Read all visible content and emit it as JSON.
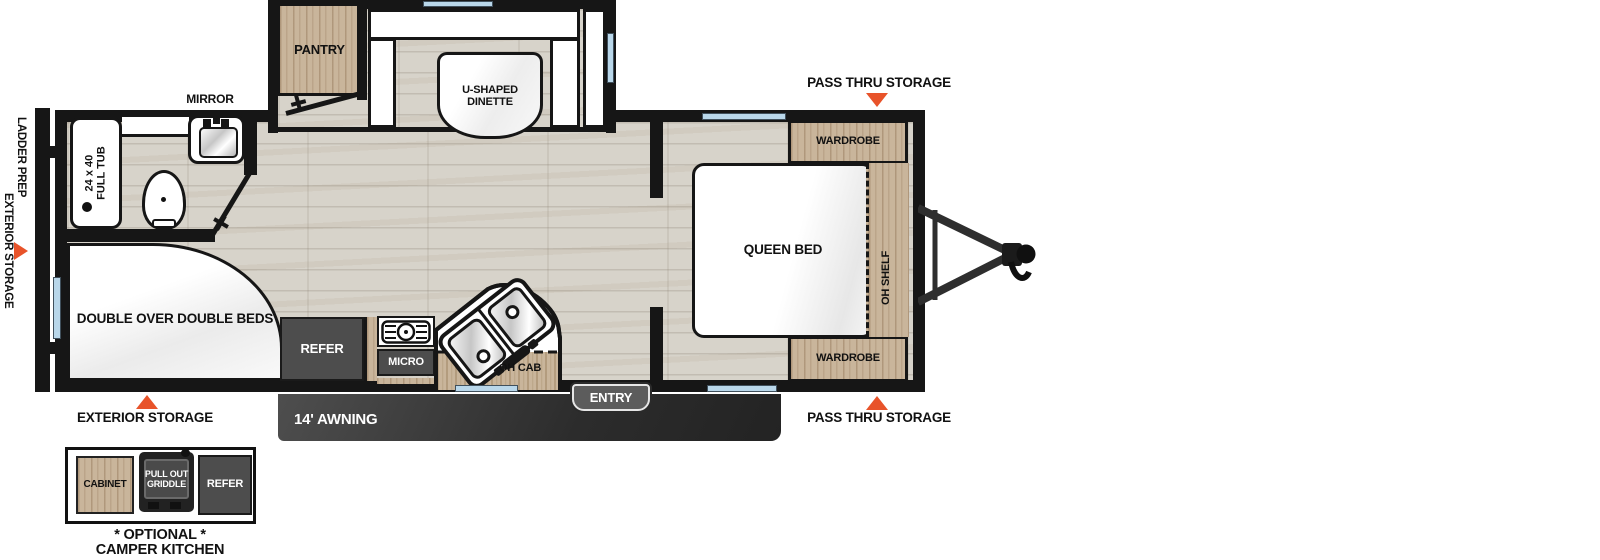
{
  "colors": {
    "wall": "#161616",
    "wood": "#c9b59b",
    "floor": "#d7d3ca",
    "appliance_dark": "#4d4d4d",
    "accent_triangle": "#e8532a",
    "window_blue": "#b9d7ea",
    "awning_bar": "#3a3a3a",
    "badge_gray": "#5c5c5c"
  },
  "floorplan": {
    "slideout": {
      "pantry": "PANTRY",
      "dinette_line1": "U-SHAPED",
      "dinette_line2": "DINETTE"
    },
    "bathroom": {
      "mirror": "MIRROR",
      "tub_line1": "24 x 40",
      "tub_line2": "FULL TUB"
    },
    "bunk": {
      "label": "DOUBLE OVER DOUBLE BEDS"
    },
    "kitchen": {
      "refer": "REFER",
      "micro": "MICRO",
      "oh_cab": "OH CAB"
    },
    "bedroom": {
      "queen_bed": "QUEEN BED",
      "wardrobe_top": "WARDROBE",
      "wardrobe_bottom": "WARDROBE",
      "oh_shelf": "OH SHELF"
    },
    "callouts": {
      "pass_thru_top": "PASS THRU STORAGE",
      "pass_thru_bottom": "PASS THRU STORAGE",
      "exterior_storage_bottom": "EXTERIOR STORAGE",
      "exterior_storage_side": "EXTERIOR STORAGE",
      "ladder_prep": "LADDER PREP",
      "entry": "ENTRY",
      "awning": "14' AWNING"
    }
  },
  "inset": {
    "cabinet": "CABINET",
    "griddle_line1": "PULL OUT",
    "griddle_line2": "GRIDDLE",
    "refer": "REFER",
    "caption_line1": "* OPTIONAL *",
    "caption_line2": "CAMPER KITCHEN"
  }
}
